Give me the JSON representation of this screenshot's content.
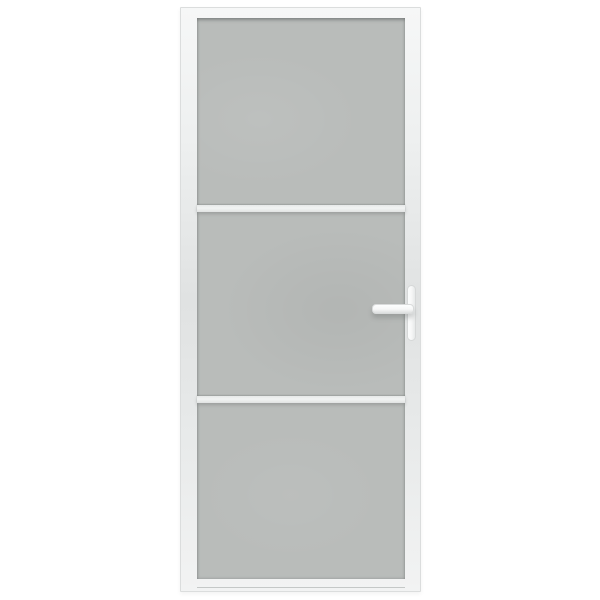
{
  "image": {
    "type": "product-photo",
    "subject": "interior frosted glass door",
    "description": "White interior door with a frosted grey glass insert divided into three panels by two horizontal white bars, and a white lever handle with vertical backplate on the right stile",
    "background_color": "#ffffff"
  },
  "door": {
    "frame_color": "#f6f7f7",
    "frame_shade_color": "#e0e2e2",
    "frame_border_color": "#dbdddd",
    "glass_color": "#b9bcba",
    "glass_panel_count": 3,
    "divider_count": 2,
    "divider_color": "#f2f4f3",
    "handle": {
      "side": "right",
      "type": "lever",
      "color": "#f7f8f8",
      "outline_color": "#d6d8d8"
    }
  }
}
